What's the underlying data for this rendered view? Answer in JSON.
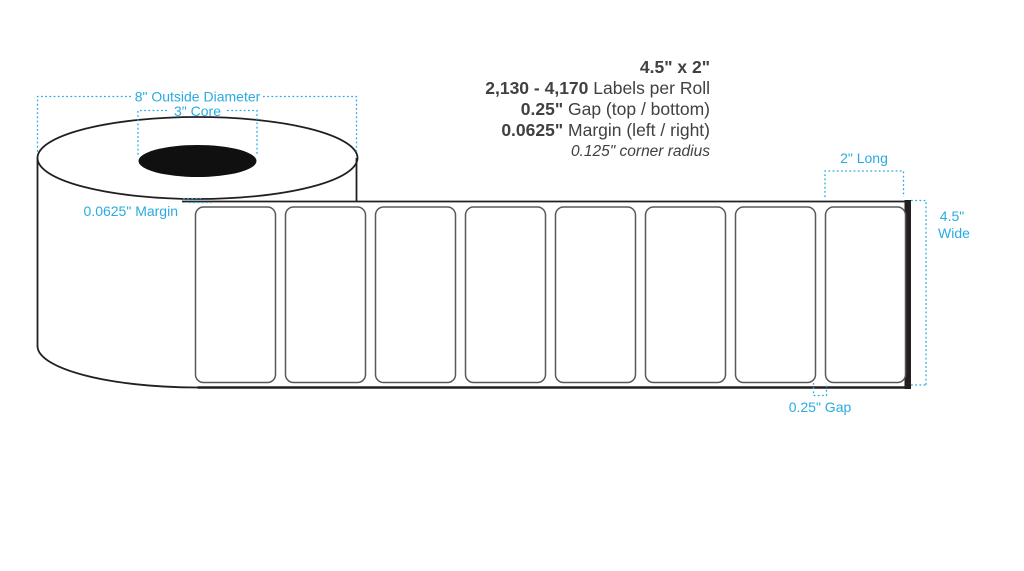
{
  "title_block": {
    "size": "4.5\" x 2\"",
    "count_bold": "2,130 - 4,170",
    "count_rest": " Labels per Roll",
    "gap_bold": "0.25\"",
    "gap_rest": " Gap (top / bottom)",
    "margin_bold": "0.0625\"",
    "margin_rest": " Margin (left / right)",
    "corner_radius": "0.125\" corner radius"
  },
  "annotations": {
    "outside_diameter": "8\" Outside Diameter",
    "core": "3\" Core",
    "margin": "0.0625\" Margin",
    "label_length": "2\" Long",
    "label_width_line1": "4.5\"",
    "label_width_line2": "Wide",
    "gap": "0.25\" Gap"
  },
  "diagram": {
    "label_count": 8,
    "first_label_x": 195.5,
    "label_pitch": 90,
    "label_y": 207,
    "label_w": 80,
    "label_h": 175.5,
    "corner_radius_px": 8
  },
  "colors": {
    "annotation_blue": "#29ABE2",
    "outline_dark": "#231F20",
    "label_outline": "#58585A",
    "spec_text": "#414042"
  }
}
